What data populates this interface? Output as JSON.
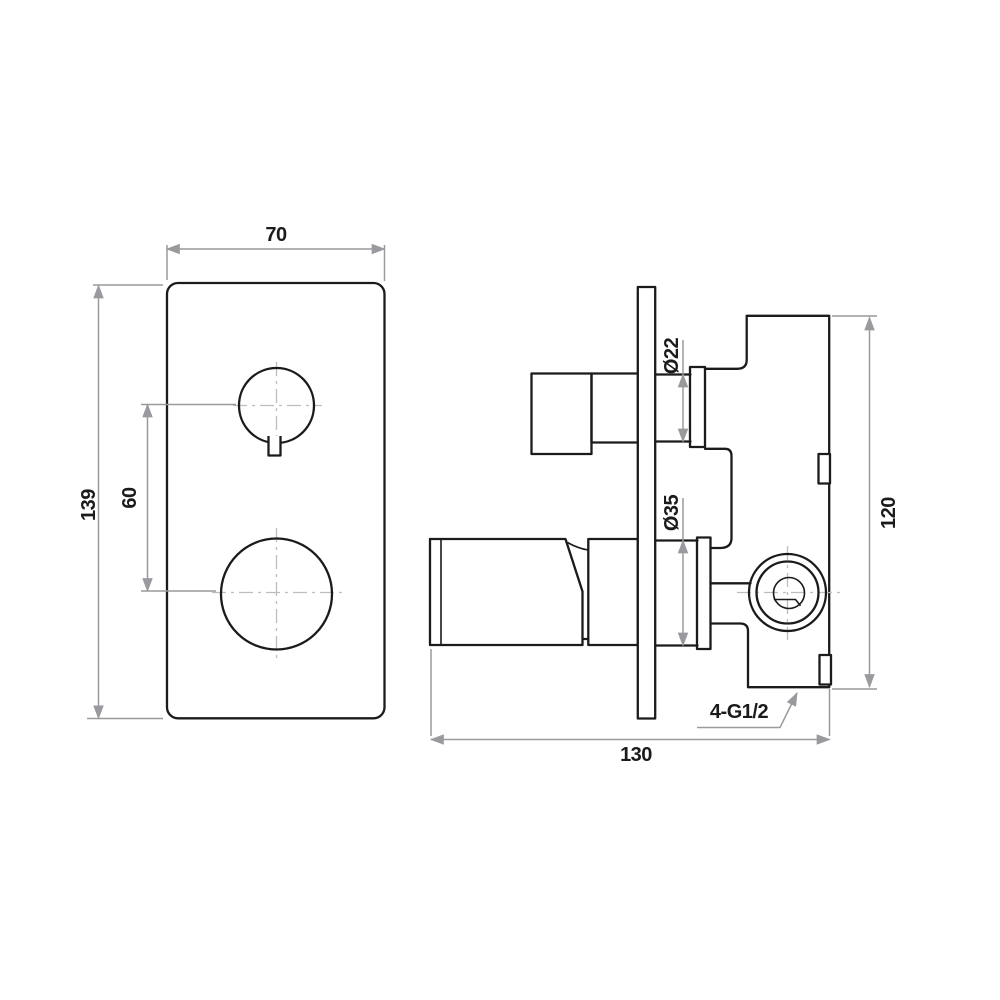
{
  "drawing": {
    "type": "technical-dimension-drawing",
    "subject": "wall-mixer-valve-two-views",
    "background_color": "#ffffff",
    "outline_color": "#1b1b1b",
    "dimension_color": "#9a9a9e",
    "centerline_color": "#bdbdbf",
    "labels": {
      "plate_width": "70",
      "plate_height": "139",
      "knob_spacing": "60",
      "upper_stem_diameter": "Ø22",
      "lower_stem_diameter": "Ø35",
      "body_height": "120",
      "overall_depth": "130",
      "thread_ports": "4-G1/2"
    }
  }
}
